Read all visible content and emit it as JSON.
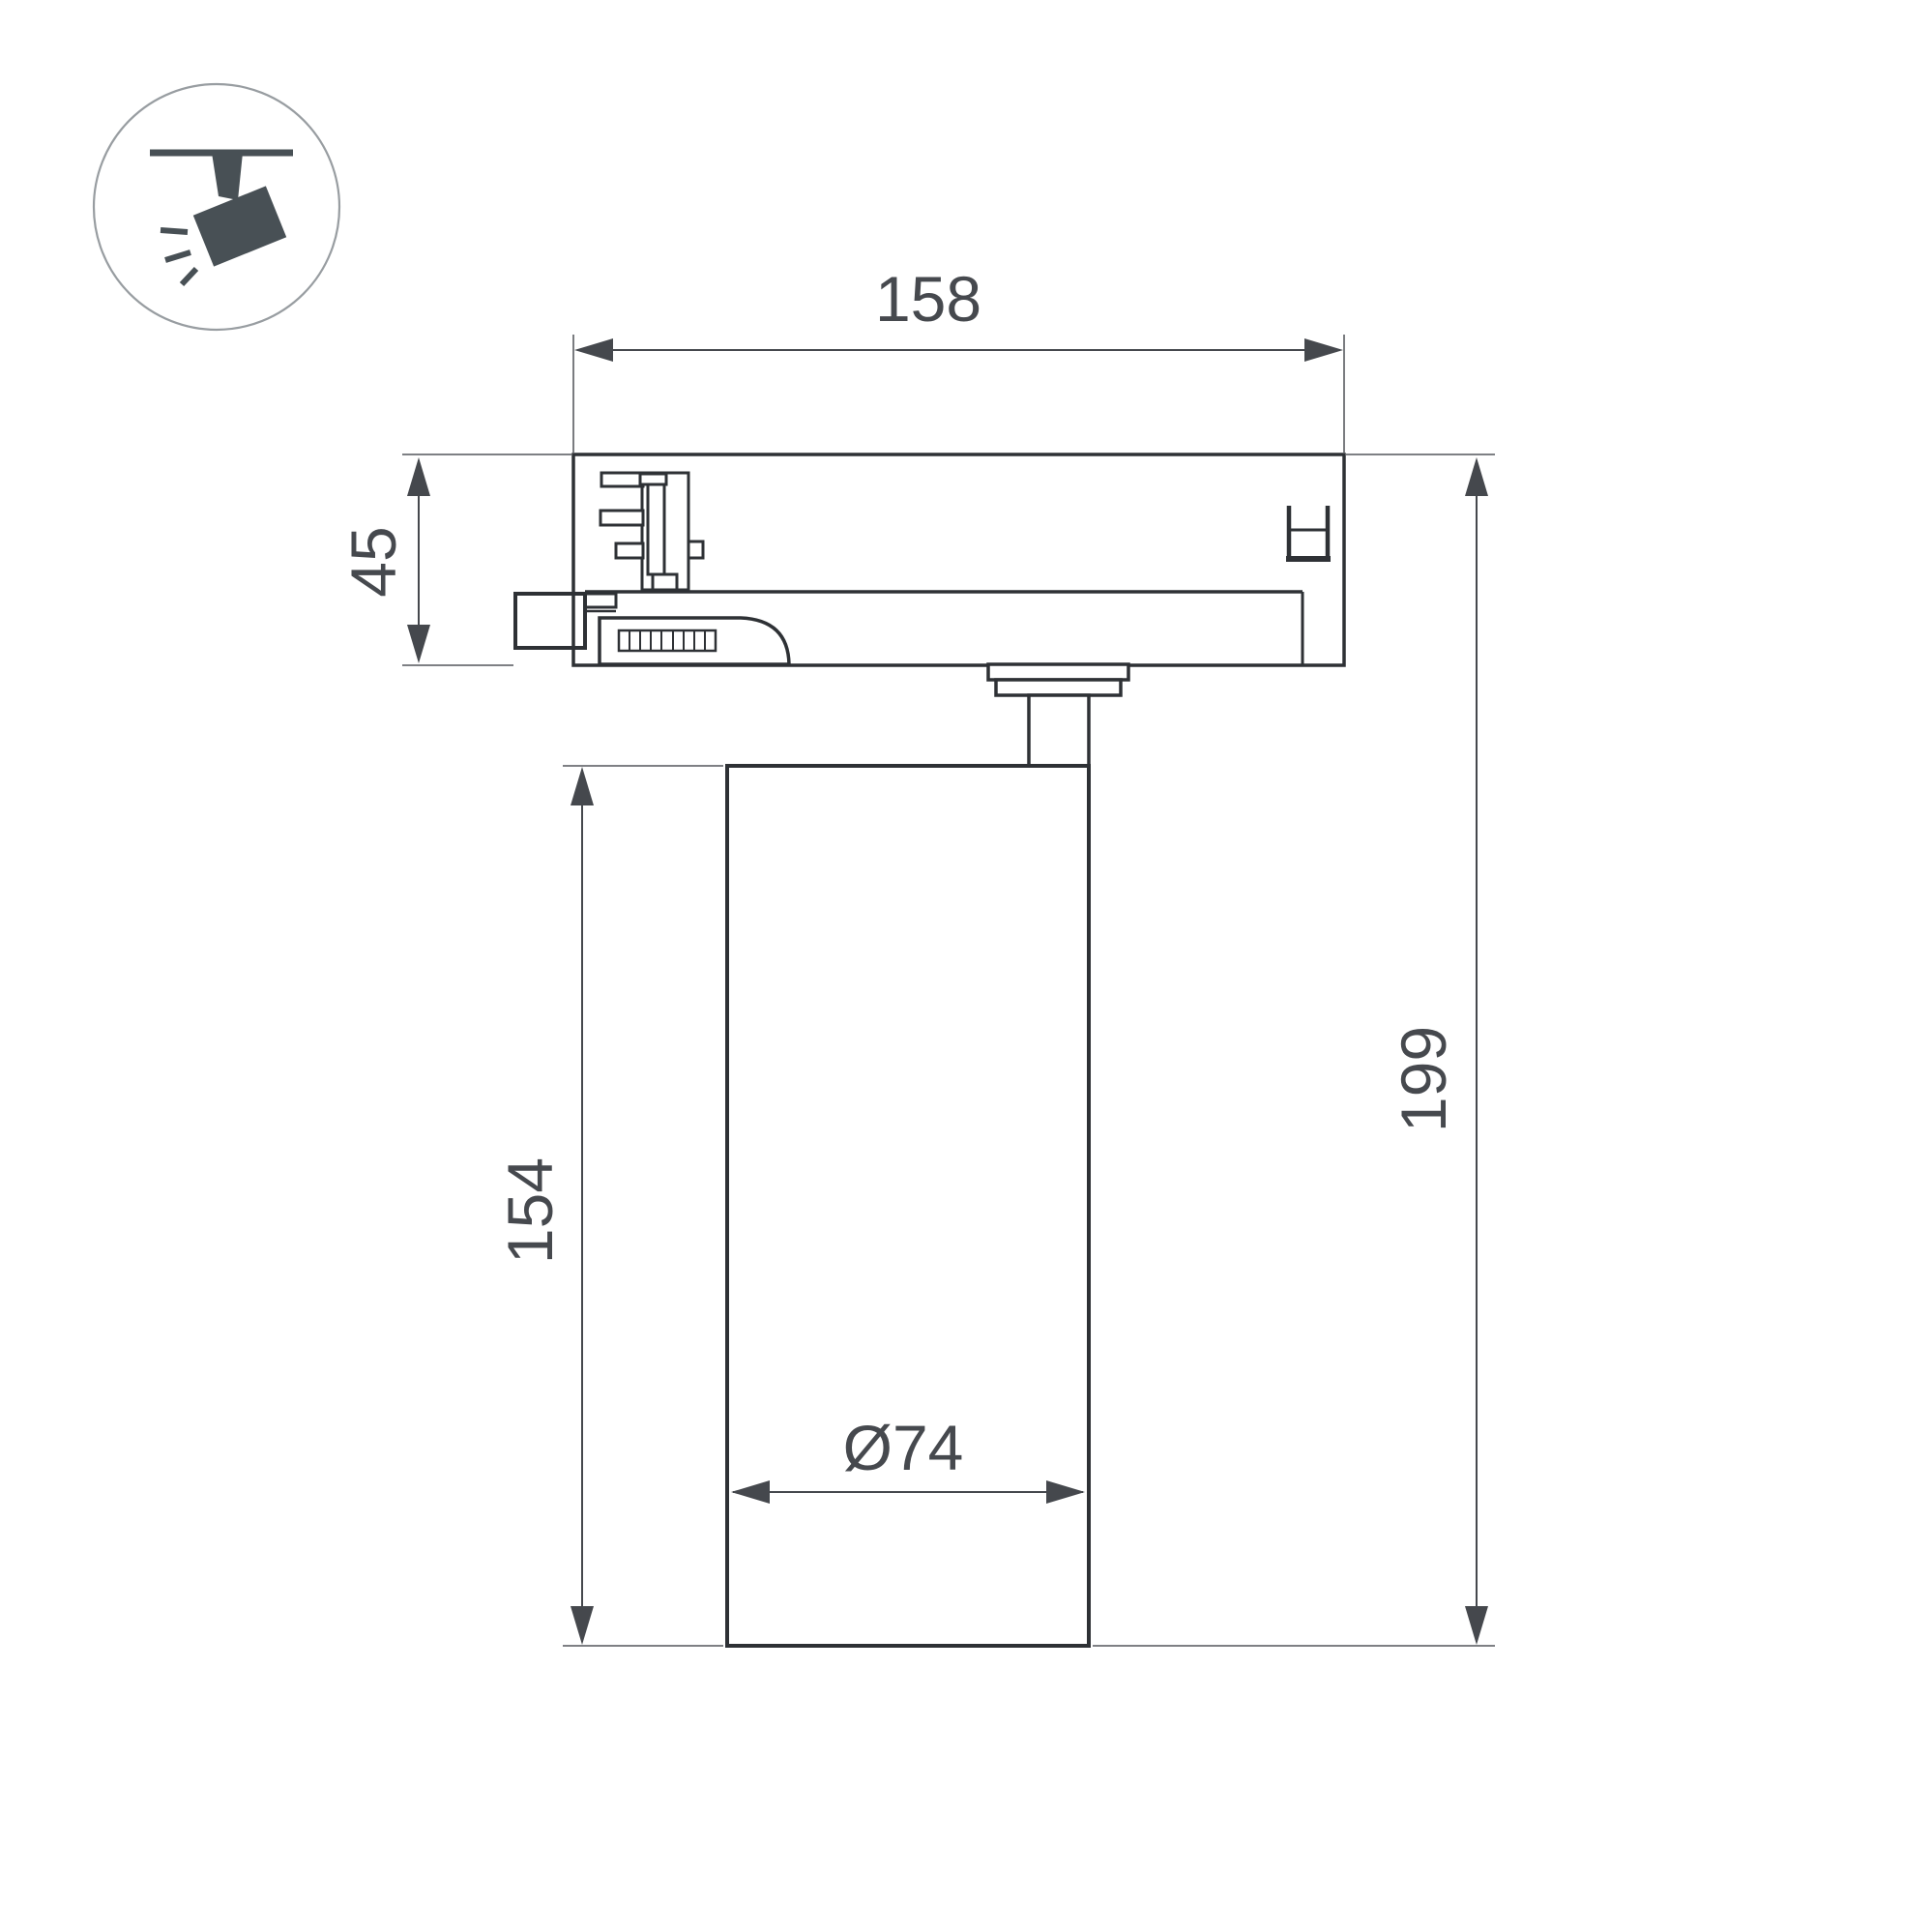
{
  "page": {
    "kind": "technical-dimension-drawing",
    "subject": "track-mounted spotlight luminaire, side view"
  },
  "colors": {
    "bg": "#ffffff",
    "outline": "#2e3135",
    "dimc": "#45484d",
    "extc": "#6b6e72",
    "textc": "#46494e",
    "iconc": "#485055",
    "circlec": "#989da1"
  },
  "icon": {
    "name": "track-spotlight-icon",
    "description": "spotlight hanging from ceiling track, tilted, with light rays"
  },
  "drawing": {
    "dims": {
      "adapter_width": "158",
      "adapter_height": "45",
      "body_height": "154",
      "total_height": "199",
      "body_diameter": "Ø74"
    }
  }
}
